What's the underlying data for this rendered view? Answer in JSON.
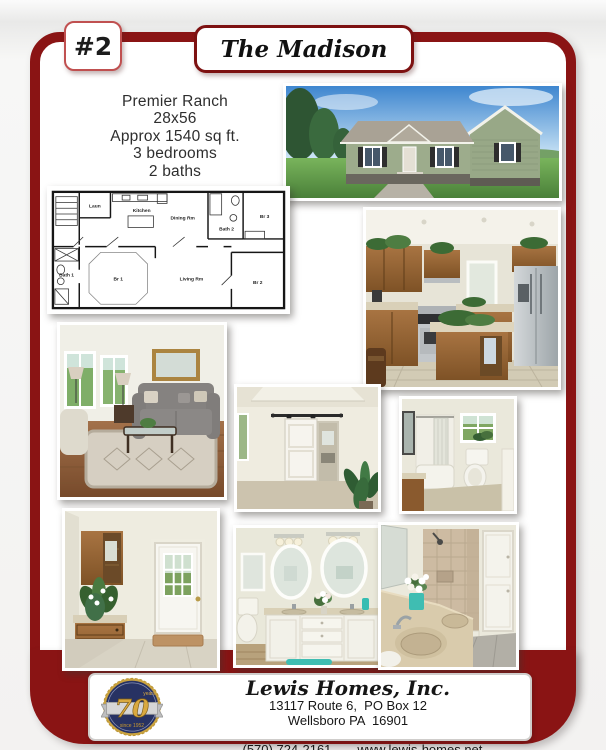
{
  "header": {
    "number": "#2",
    "title": "The Madison"
  },
  "specs": [
    "Premier Ranch",
    "28x56",
    "Approx 1540 sq ft.",
    "3 bedrooms",
    "2 baths"
  ],
  "floor_plan": {
    "laun": "Laun",
    "kitchen": "Kitchen",
    "dining": "Dining Rm",
    "bath2": "Bath 2",
    "br3": "Br 3",
    "bath1": "Bath 1",
    "br1": "Br 1",
    "living": "Living Rm",
    "br2": "Br 2"
  },
  "footer": {
    "company": "Lewis Homes, Inc.",
    "address1": "13117 Route 6,  PO Box 12",
    "address2": "Wellsboro PA  16901",
    "phone": "(570) 724-2161",
    "website": "www.lewis-homes.net"
  },
  "logo": {
    "number": "70",
    "caption_top": "years",
    "caption_bottom": "since 1952"
  },
  "colors": {
    "maroon": "#8a1414",
    "badge_border": "#c05050",
    "logo_navy": "#273263",
    "logo_gold": "#d2a43c"
  }
}
